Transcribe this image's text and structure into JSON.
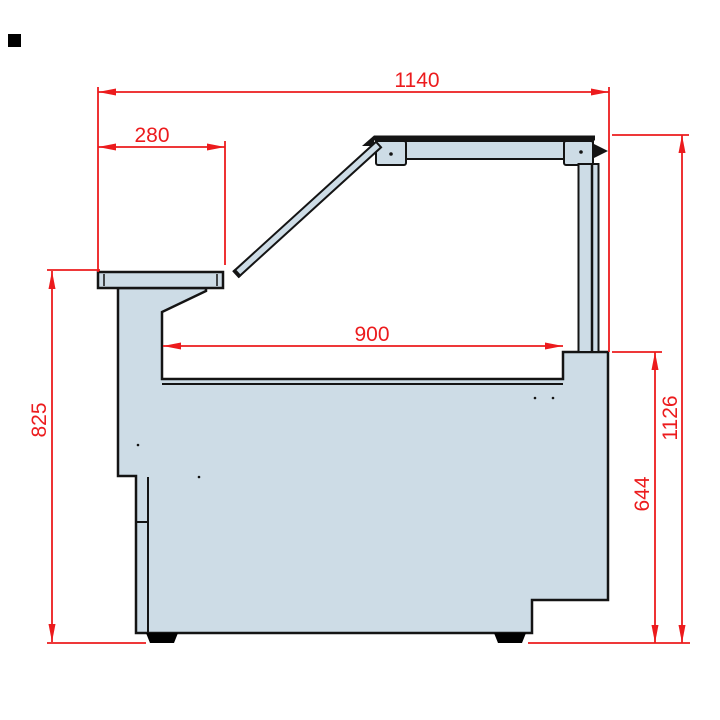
{
  "drawing": {
    "type": "technical-dimension-drawing",
    "subject": "serve-over display counter side profile",
    "colors": {
      "dimension_red": "#ec1b1d",
      "outline_black": "#141414",
      "panel_fill": "#cddce6",
      "marker_black": "#000000",
      "background": "#ffffff"
    },
    "dimensions": {
      "total_width_mm": "1140",
      "shelf_depth_mm": "280",
      "well_opening_mm": "900",
      "counter_height_mm": "825",
      "rear_body_height_mm": "644",
      "overall_height_mm": "1126"
    }
  }
}
